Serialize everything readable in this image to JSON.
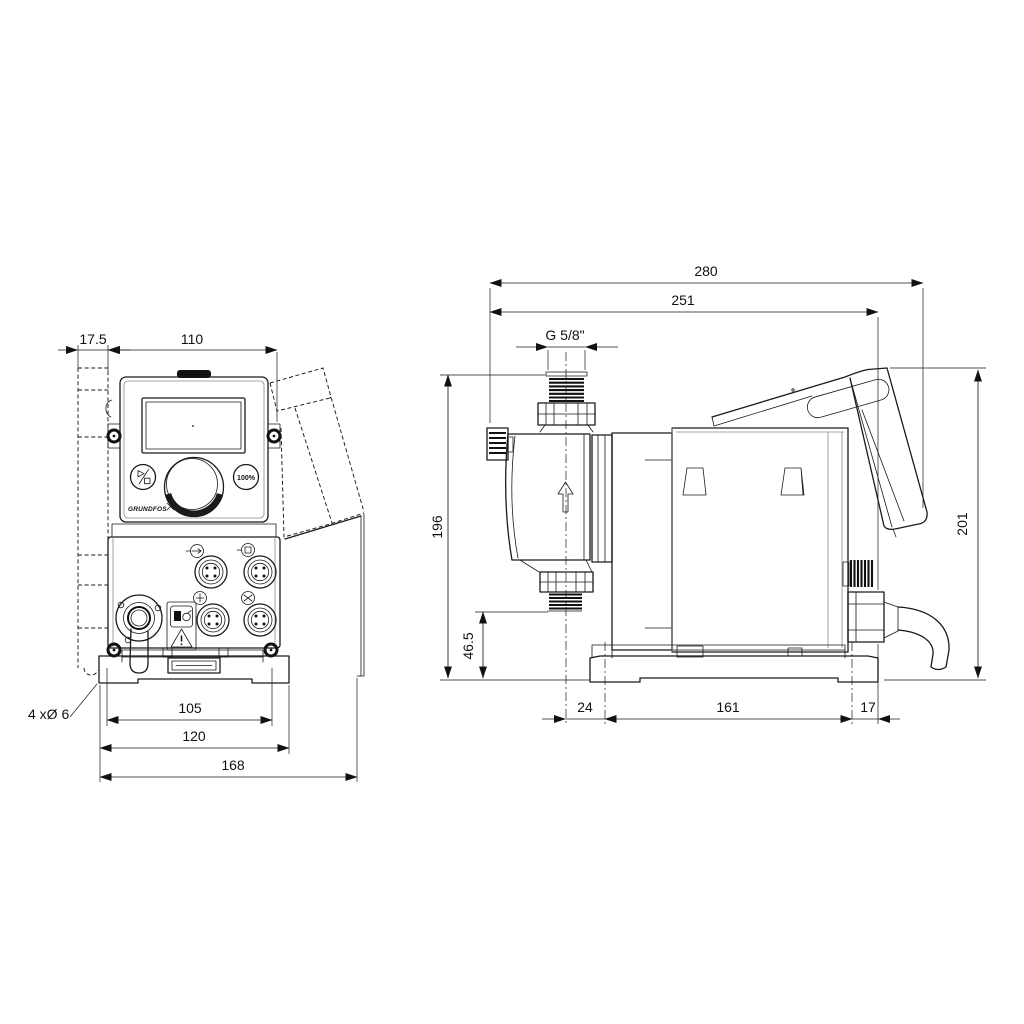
{
  "drawing": {
    "brand": "GRUNDFOS",
    "front_view": {
      "dim_bracket_offset": "17.5",
      "dim_housing_width": "110",
      "dim_slot_spacing": "105",
      "dim_base_width": "120",
      "dim_overall_width": "168",
      "label_mounting_holes": "4 xØ 6",
      "button_100_label": "100%"
    },
    "side_view": {
      "dim_overall_depth": "280",
      "dim_depth_to_plug": "251",
      "label_thread": "G 5/8\"",
      "dim_height_to_port": "196",
      "dim_outlet_height": "46.5",
      "dim_base_front_offset": "24",
      "dim_base_hole_spacing": "161",
      "dim_base_rear_offset": "17",
      "dim_overall_height": "201"
    }
  }
}
